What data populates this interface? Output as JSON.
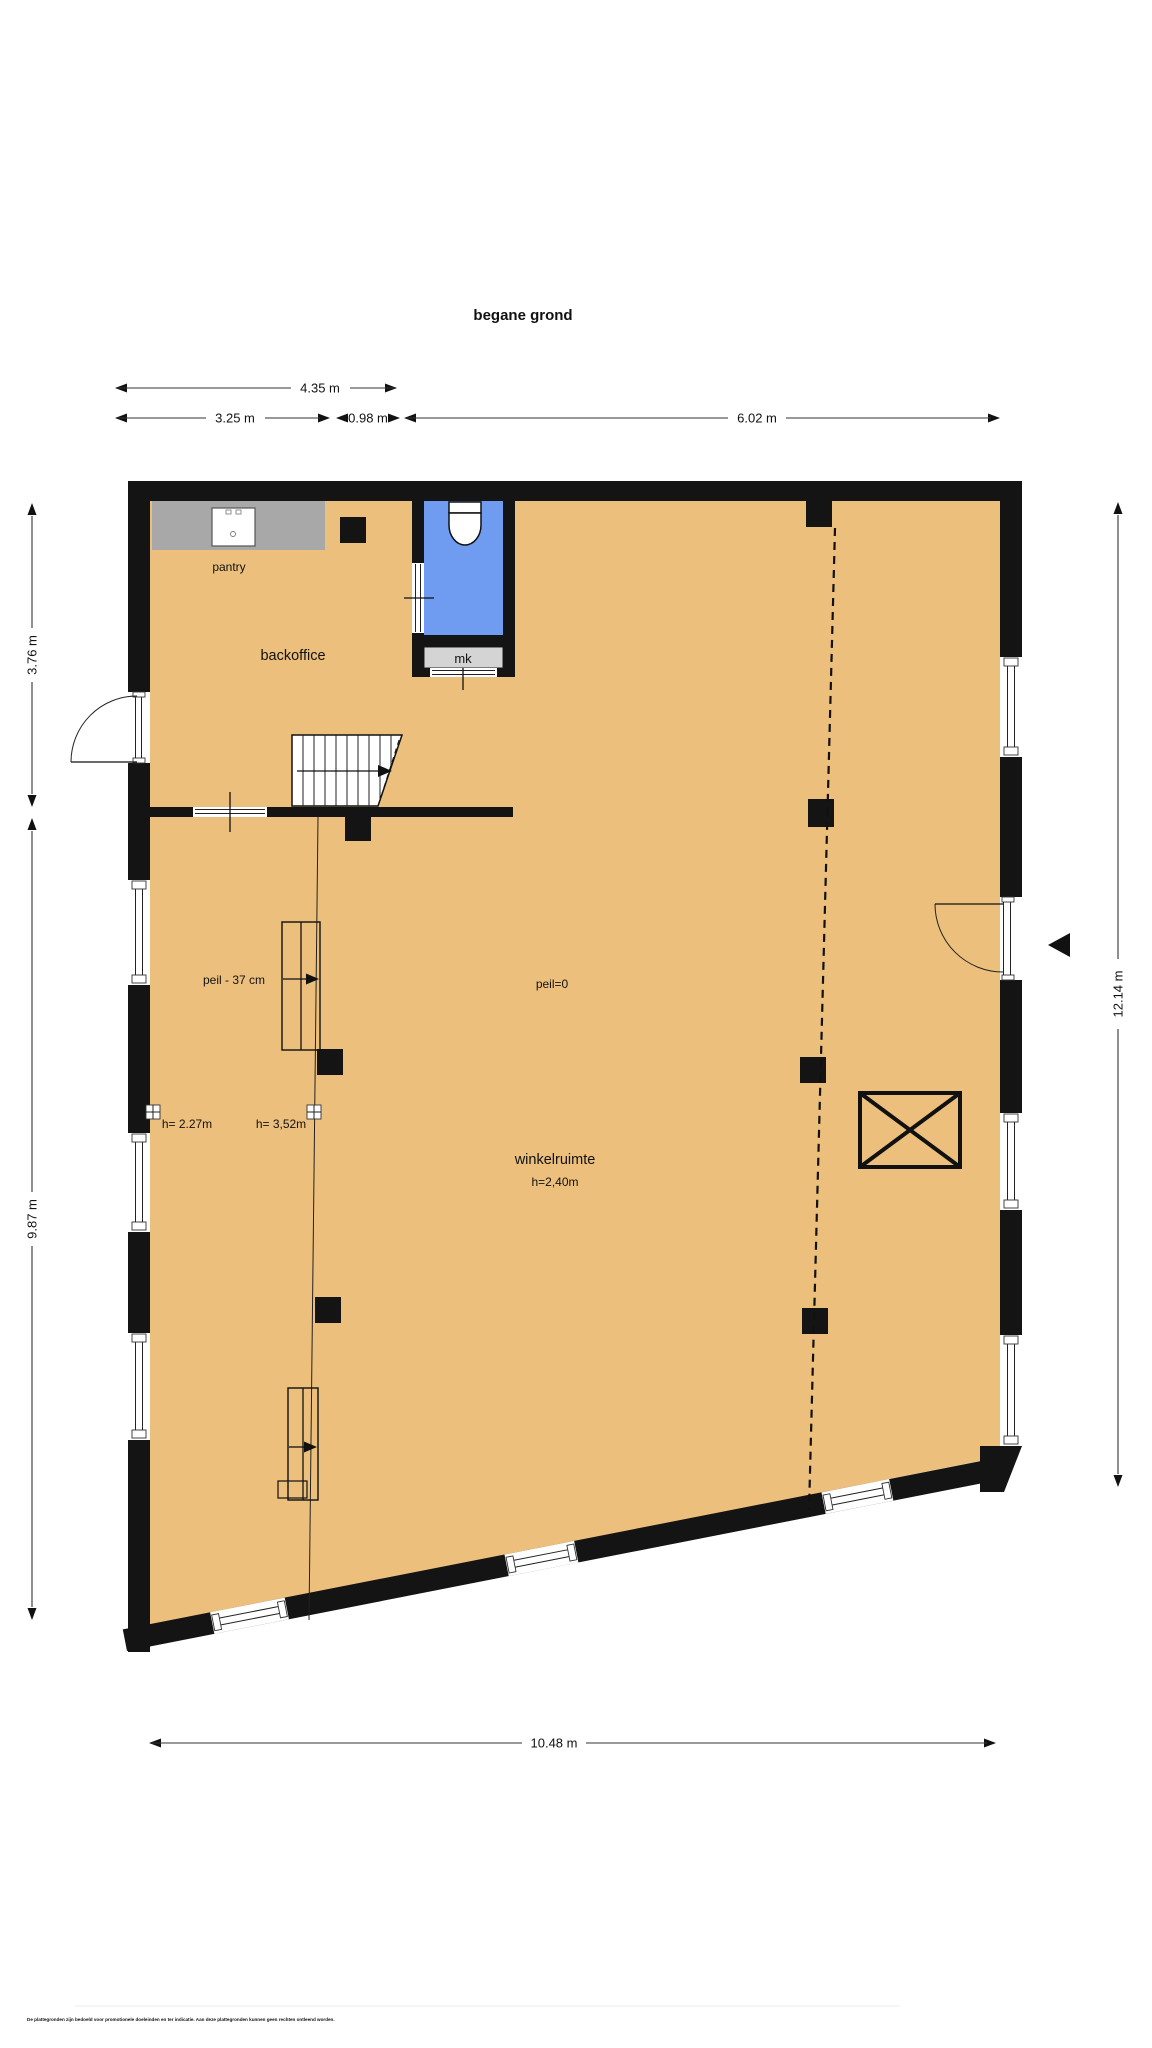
{
  "title": "begane grond",
  "disclaimer": "De plattegronden zijn bedoeld voor promotionele doeleinden en ter indicatie. Aan deze plattegronden kunnen geen rechten ontleend worden.",
  "dimensions": {
    "top_overall": "4.35 m",
    "top_left": "3.25 m",
    "top_middle": "0.98 m",
    "top_right": "6.02 m",
    "left_upper": "3.76 m",
    "left_lower": "9.87 m",
    "right_side": "12.14 m",
    "bottom": "10.48 m"
  },
  "rooms": {
    "pantry": {
      "label": "pantry"
    },
    "backoffice": {
      "label": "backoffice"
    },
    "meter_closet": {
      "label": "mk"
    },
    "shop": {
      "label": "winkelruimte",
      "height": "h=2,40m"
    }
  },
  "annotations": {
    "level_lowered": "peil - 37 cm",
    "level_zero": "peil=0",
    "height_left": "h= 2.27m",
    "height_middle": "h= 3,52m"
  },
  "icons": {
    "entrance_arrow": "entrance-direction",
    "stairs_arrow": "stairs-up-direction",
    "shaft": "crossed-shaft-box"
  },
  "colors": {
    "floor": "#ecc07c",
    "wall": "#141414",
    "toilet_room": "#6f9cf1",
    "meter_closet": "#d4d4d4",
    "counter": "#a8a8a8"
  }
}
